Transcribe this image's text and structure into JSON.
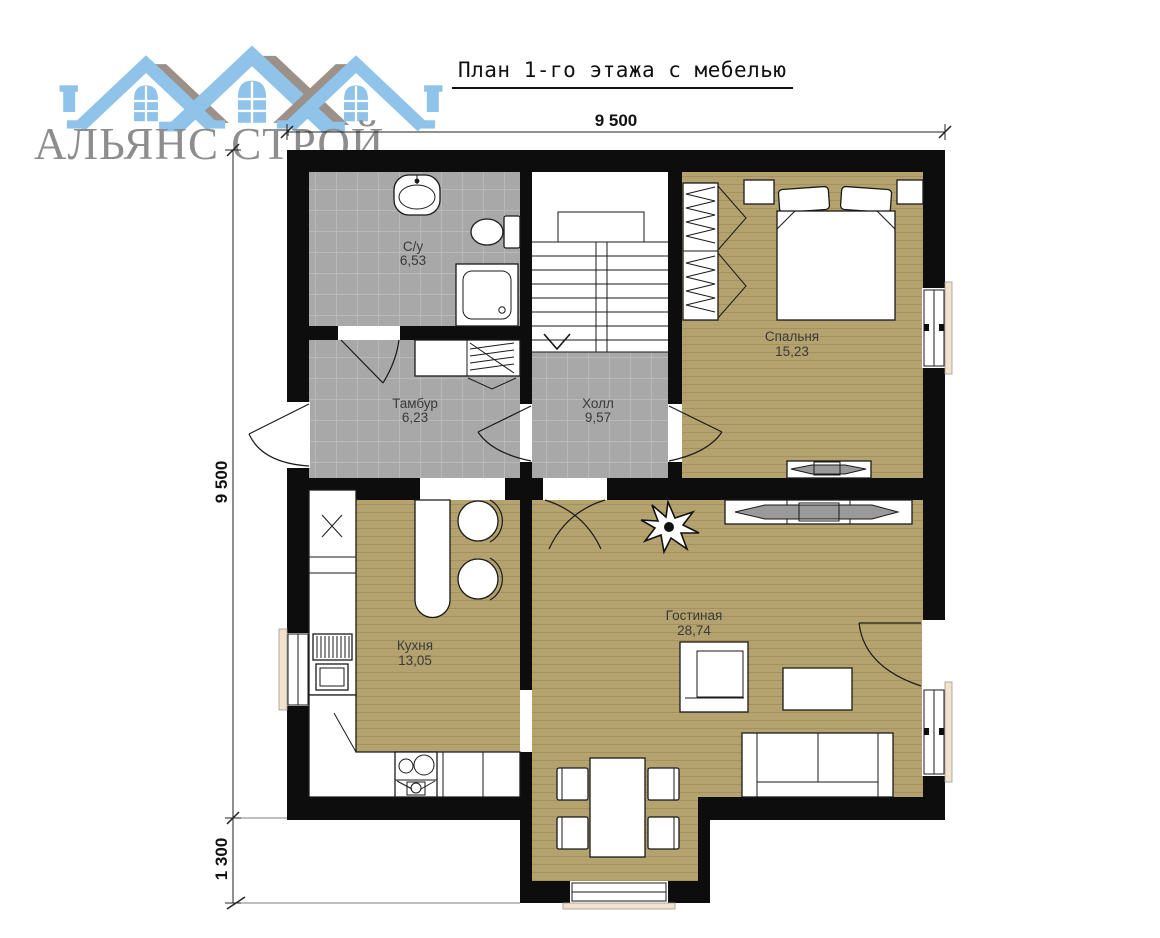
{
  "logo": {
    "text": "АЛЬЯНС СТРОЙ"
  },
  "title": "План 1-го этажа с мебелью",
  "dimensions": {
    "top": "9 500",
    "left": "9 500",
    "bottom_left": "1 300"
  },
  "rooms": [
    {
      "name": "С/у",
      "area": "6,53"
    },
    {
      "name": "Тамбур",
      "area": "6,23"
    },
    {
      "name": "Холл",
      "area": "9,57"
    },
    {
      "name": "Спальня",
      "area": "15,23"
    },
    {
      "name": "Кухня",
      "area": "13,05"
    },
    {
      "name": "Гостиная",
      "area": "28,74"
    }
  ],
  "furniture_icons": [
    "sink-icon",
    "toilet-icon",
    "shower-icon",
    "closet-icon",
    "stairs-icon",
    "wardrobe-icon",
    "bed-icon",
    "nightstand-icon",
    "tv-stand-icon",
    "kitchen-counter-icon",
    "washing-machine-icon",
    "stove-icon",
    "bar-table-icon",
    "bar-stool-icon",
    "plant-icon",
    "armchair-icon",
    "coffee-table-icon",
    "sofa-icon",
    "dining-table-icon",
    "dining-chair-icon",
    "door-arc-icon",
    "window-icon"
  ],
  "colors": {
    "wall": "#0d0d0d",
    "tile": "#a8a8a8",
    "tile_line": "#b9b9b9",
    "wood": "#b4a36f",
    "wood_line": "#a3925e",
    "sill": "#f4e3cc",
    "logo_blue": "#8fc3ea",
    "logo_gray": "#9b9189",
    "logo_text_color": "#8d8d8d"
  }
}
